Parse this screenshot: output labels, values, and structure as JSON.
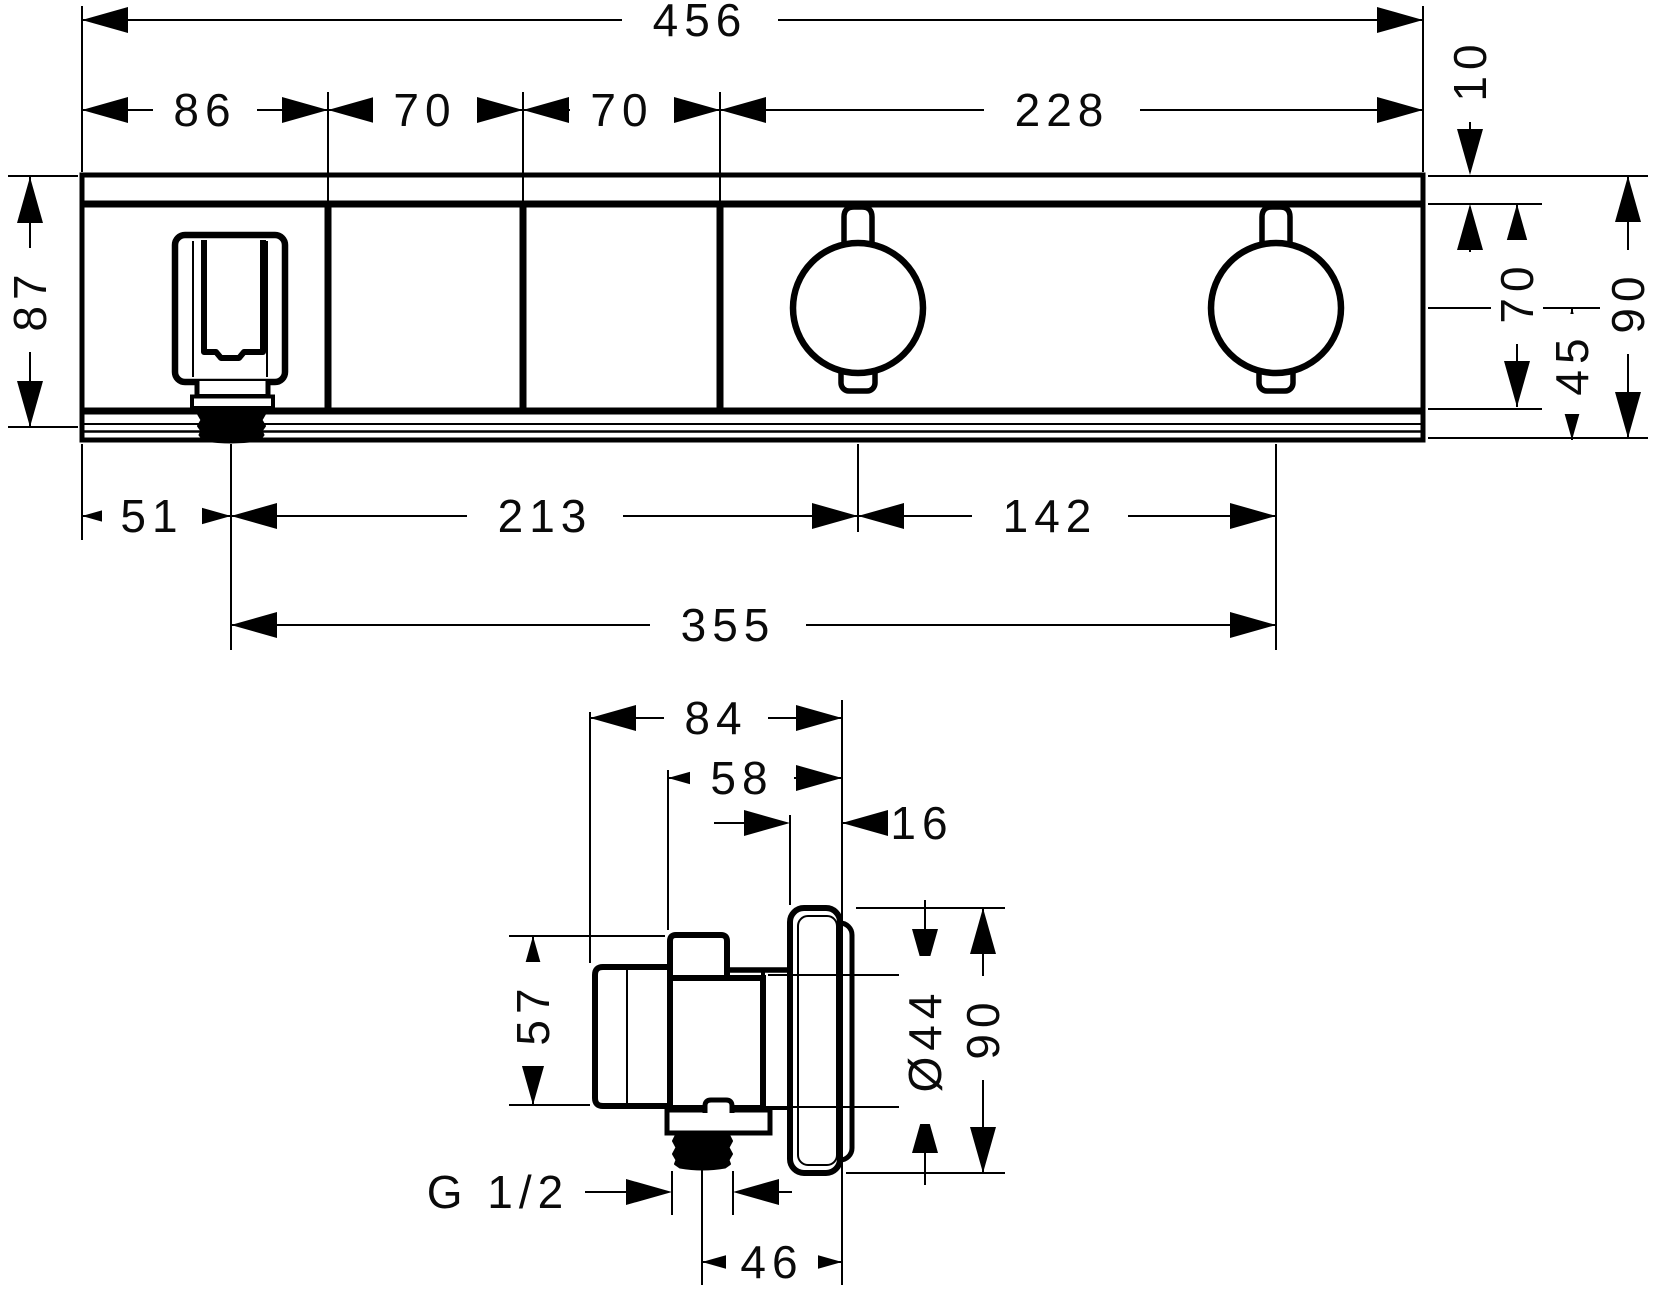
{
  "drawing": {
    "kind": "technical dimension drawing",
    "views": {
      "front_view": "front elevation of shower thermostat module",
      "side_view": "side section of valve body with wall plate"
    }
  },
  "colors": {
    "ink": "#000000",
    "paper": "#ffffff"
  },
  "front_view": {
    "overall_width": "456",
    "section_holder": "86",
    "section_blank_left": "70",
    "section_blank_right": "70",
    "section_controls": "228",
    "top_trim_height": "10",
    "body_height_left": "87",
    "face_height": "70",
    "axis_to_base": "45",
    "overall_height": "90",
    "edge_to_outlet": "51",
    "outlet_to_knob1": "213",
    "knob1_to_knob2": "142",
    "outlet_to_knob2": "355"
  },
  "side_view": {
    "overall_depth": "84",
    "body_depth": "58",
    "plate_thickness": "16",
    "body_height": "57",
    "cartridge_diameter": "Ø44",
    "plate_height": "90",
    "outlet_thread": "G 1/2",
    "outlet_axis_to_wall": "46"
  }
}
